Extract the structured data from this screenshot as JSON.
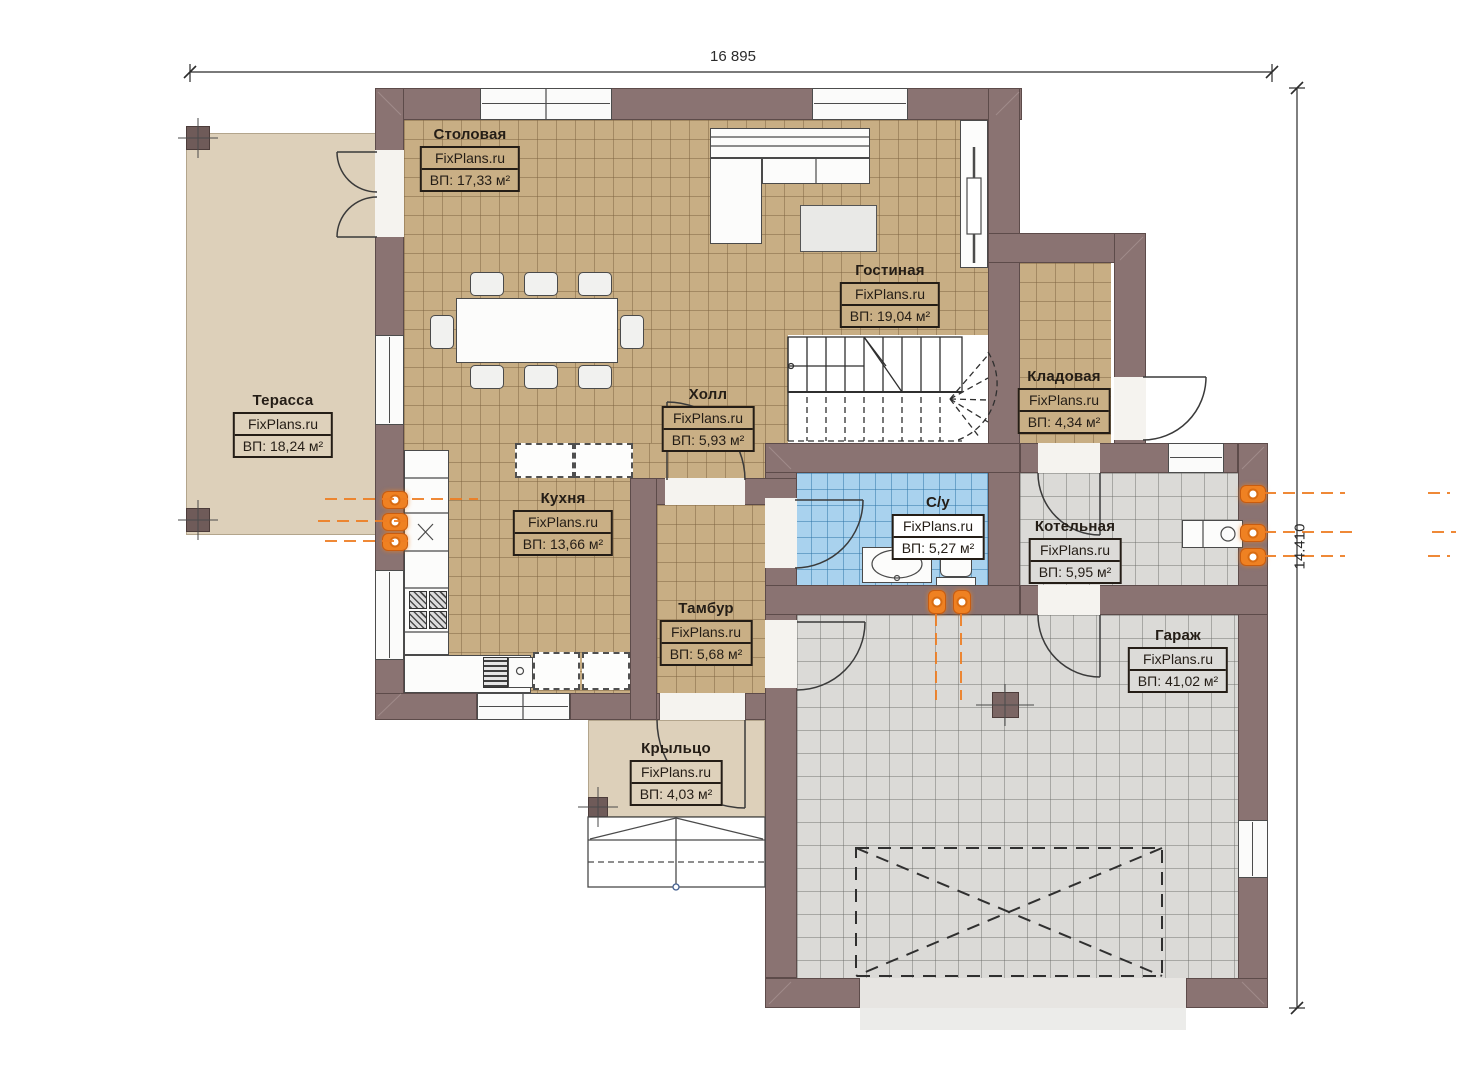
{
  "plan": {
    "dim_top": "16 895",
    "dim_right": "14.410"
  },
  "watermark": "FixPlans.ru",
  "rooms": [
    {
      "id": "terrace",
      "name": "Терасса",
      "watermark": "FixPlans.ru",
      "area": "ВП: 18,24 м²"
    },
    {
      "id": "dining",
      "name": "Столовая",
      "watermark": "FixPlans.ru",
      "area": "ВП: 17,33 м²"
    },
    {
      "id": "living",
      "name": "Гостиная",
      "watermark": "FixPlans.ru",
      "area": "ВП: 19,04 м²"
    },
    {
      "id": "storage",
      "name": "Кладовая",
      "watermark": "FixPlans.ru",
      "area": "ВП: 4,34 м²"
    },
    {
      "id": "hall",
      "name": "Холл",
      "watermark": "FixPlans.ru",
      "area": "ВП: 5,93 м²"
    },
    {
      "id": "kitchen",
      "name": "Кухня",
      "watermark": "FixPlans.ru",
      "area": "ВП: 13,66 м²"
    },
    {
      "id": "bathroom",
      "name": "С/у",
      "watermark": "FixPlans.ru",
      "area": "ВП: 5,27 м²"
    },
    {
      "id": "boiler",
      "name": "Котельная",
      "watermark": "FixPlans.ru",
      "area": "ВП: 5,95 м²"
    },
    {
      "id": "vestibule",
      "name": "Тамбур",
      "watermark": "FixPlans.ru",
      "area": "ВП: 5,68 м²"
    },
    {
      "id": "garage",
      "name": "Гараж",
      "watermark": "FixPlans.ru",
      "area": "ВП: 41,02 м²"
    },
    {
      "id": "porch",
      "name": "Крыльцо",
      "watermark": "FixPlans.ru",
      "area": "ВП: 4,03 м²"
    }
  ],
  "colors": {
    "wall": "#8a7372",
    "floor_tan": "#c8ae84",
    "floor_gray": "#dbdad7",
    "floor_blue": "#a9d2ee",
    "terrace": "#ddd0ba",
    "radiator": "#ef8122"
  }
}
